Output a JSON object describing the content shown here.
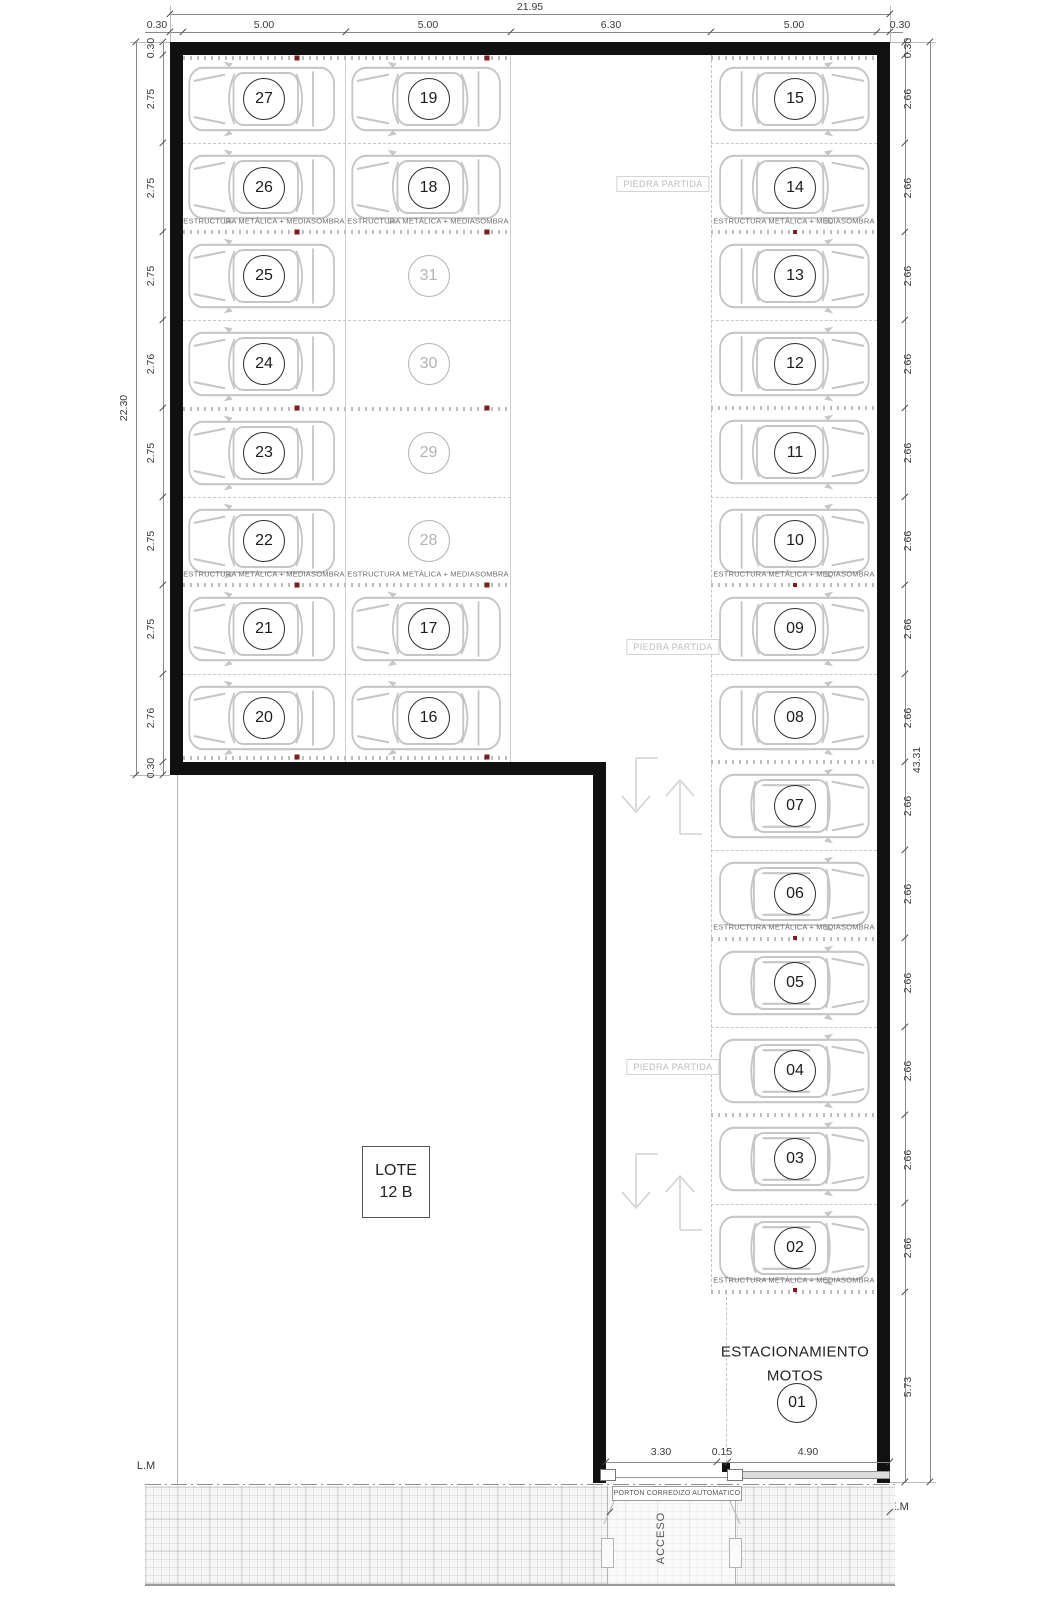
{
  "plan": {
    "top_dims": {
      "overall": "21.95",
      "segments": [
        "0.30",
        "5.00",
        "5.00",
        "6.30",
        "5.00",
        "0.30"
      ]
    },
    "left_dims": {
      "overall": "22.30",
      "top_wall": "0.30",
      "bottom_wall": "0.30",
      "rows": [
        "2.75",
        "2.75",
        "2.75",
        "2.76",
        "2.75",
        "2.75",
        "2.75",
        "2.76"
      ]
    },
    "right_dims": {
      "overall": "43.31",
      "top_wall": "0.30",
      "rows": [
        "2.66",
        "2.66",
        "2.66",
        "2.66",
        "2.66",
        "2.66",
        "2.66",
        "2.66",
        "2.66",
        "2.66",
        "2.66",
        "2.66",
        "2.66",
        "2.66"
      ],
      "motos": "5.73"
    },
    "bottom_dims": {
      "segments": [
        "3.30",
        "0.15",
        "4.90"
      ],
      "gate": "8.65"
    },
    "labels": {
      "estructura": "ESTRUCTURA METÁLICA + MEDIASOMBRA",
      "piedra_partida": "PIEDRA PARTIDA",
      "porton": "PORTON CORREDIZO AUTOMATICO",
      "acceso": "ACCESO",
      "lm": "L.M",
      "em": "E.M",
      "lote_line1": "LOTE",
      "lote_line2": "12 B",
      "motos_line1": "ESTACIONAMIENTO",
      "motos_line2": "MOTOS"
    },
    "left_block": {
      "col_a": [
        {
          "n": "27",
          "car": true
        },
        {
          "n": "26",
          "car": true
        },
        {
          "n": "25",
          "car": true
        },
        {
          "n": "24",
          "car": true
        },
        {
          "n": "23",
          "car": true
        },
        {
          "n": "22",
          "car": true
        },
        {
          "n": "21",
          "car": true
        },
        {
          "n": "20",
          "car": true
        }
      ],
      "col_b": [
        {
          "n": "19",
          "car": true
        },
        {
          "n": "18",
          "car": true
        },
        {
          "n": "31",
          "car": false
        },
        {
          "n": "30",
          "car": false
        },
        {
          "n": "29",
          "car": false
        },
        {
          "n": "28",
          "car": false
        },
        {
          "n": "17",
          "car": true
        },
        {
          "n": "16",
          "car": true
        }
      ]
    },
    "right_stalls": [
      {
        "n": "15",
        "car": "sedan-top-view"
      },
      {
        "n": "14",
        "car": "sedan-top-view"
      },
      {
        "n": "13",
        "car": "sedan-top-view"
      },
      {
        "n": "12",
        "car": "sedan-top-view"
      },
      {
        "n": "11",
        "car": "sedan-top-view"
      },
      {
        "n": "10",
        "car": "sedan-top-view"
      },
      {
        "n": "09",
        "car": "sedan-top-view"
      },
      {
        "n": "08",
        "car": "sedan-top-view"
      },
      {
        "n": "07",
        "car": "suv-top-view"
      },
      {
        "n": "06",
        "car": "suv-top-view"
      },
      {
        "n": "05",
        "car": "suv-top-view"
      },
      {
        "n": "04",
        "car": "suv-top-view"
      },
      {
        "n": "03",
        "car": "suv-top-view"
      },
      {
        "n": "02",
        "car": "suv-top-view"
      }
    ],
    "moto_stall": {
      "n": "01"
    },
    "colors": {
      "wall": "#111111",
      "car_line": "#c6c6c6",
      "post": "#7d1d1d",
      "dim": "#3a3a3a"
    }
  }
}
